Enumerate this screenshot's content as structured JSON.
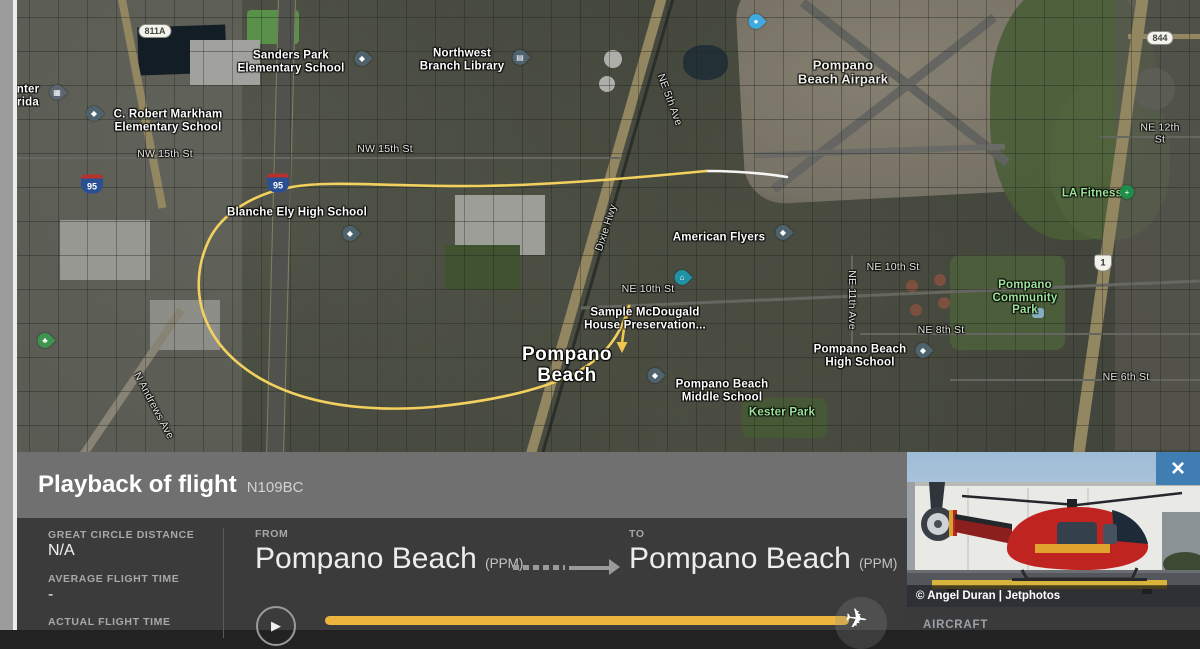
{
  "playback": {
    "title": "Playback of flight",
    "tail": "N109BC",
    "stats": [
      {
        "label": "GREAT CIRCLE DISTANCE",
        "value": "N/A"
      },
      {
        "label": "AVERAGE FLIGHT TIME",
        "value": "-"
      },
      {
        "label": "ACTUAL FLIGHT TIME",
        "value": ""
      }
    ],
    "from_label": "FROM",
    "from_city": "Pompano Beach",
    "from_code": "(PPM)",
    "to_label": "TO",
    "to_city": "Pompano Beach",
    "to_code": "(PPM)",
    "play_icon": "▶",
    "plane_icon": "✈"
  },
  "photo": {
    "credit": "© Angel Duran | Jetphotos",
    "close_icon": "×",
    "aircraft_label": "AIRCRAFT"
  },
  "map": {
    "labels": [
      {
        "text": "Sanders Park\nElementary School"
      },
      {
        "text": "Northwest\nBranch Library"
      },
      {
        "text": "C. Robert Markham\nElementary School"
      },
      {
        "text": "Blanche Ely High School"
      },
      {
        "text": "American Flyers"
      },
      {
        "text": "Sample McDougald\nHouse Preservation..."
      },
      {
        "text": "Pompano Beach\nHigh School"
      },
      {
        "text": "Pompano Beach\nMiddle School"
      },
      {
        "text": "Pompano\nBeach"
      },
      {
        "text": "Pompano\nBeach Airpark"
      },
      {
        "text": "Kester Park"
      },
      {
        "text": "LA Fitness"
      },
      {
        "text": "Pompano\nCommunity\nPark"
      },
      {
        "text": "nter\nrida"
      },
      {
        "text": "NW 15th St"
      },
      {
        "text": "NW 15th St"
      },
      {
        "text": "NE 10th St"
      },
      {
        "text": "NE 10th St"
      },
      {
        "text": "NE 8th St"
      },
      {
        "text": "NE 6th St"
      },
      {
        "text": "NE 12th St"
      },
      {
        "text": "NE 5th Ave"
      },
      {
        "text": "Dixie Hwy"
      },
      {
        "text": "NE 11th Ave"
      },
      {
        "text": "N Andrews Ave"
      }
    ],
    "shields": [
      {
        "text": "811A"
      },
      {
        "text": "95"
      },
      {
        "text": "95"
      },
      {
        "text": "844"
      },
      {
        "text": "1"
      }
    ],
    "pins": [
      {
        "glyph": "◆"
      },
      {
        "glyph": "▤"
      },
      {
        "glyph": "◆"
      },
      {
        "glyph": "◆"
      },
      {
        "glyph": "◆"
      },
      {
        "glyph": "◆"
      },
      {
        "glyph": "◆"
      },
      {
        "glyph": "⌂"
      },
      {
        "glyph": "●"
      },
      {
        "glyph": "♣"
      },
      {
        "glyph": "▦"
      },
      {
        "glyph": "+"
      }
    ]
  },
  "colors": {
    "accent_yellow": "#edb53e",
    "trail_yellow": "#f3d15f",
    "close_blue": "#3f7db2",
    "panel_dark": "#3b3b3b",
    "panel_header": "#707070"
  }
}
